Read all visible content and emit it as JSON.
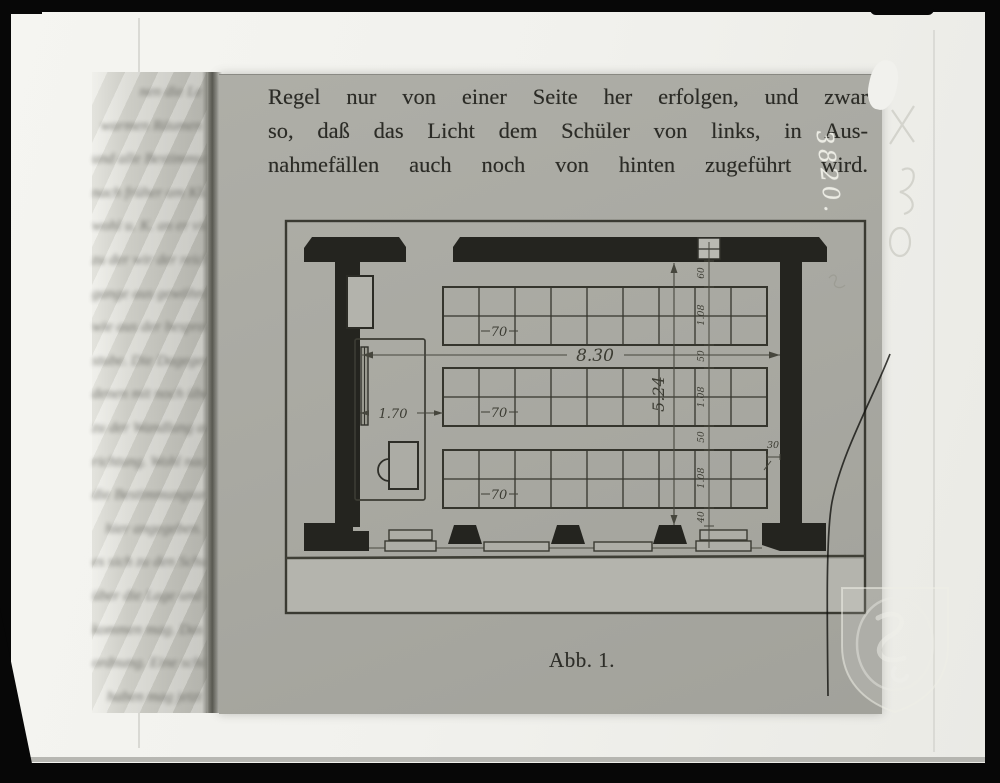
{
  "photo": {
    "handwritten_number": "3820."
  },
  "book": {
    "paragraph_lines": [
      "Regel nur von einer Seite her erfolgen, und zwar",
      "so, daß das Licht dem Schüler von links, in Aus-",
      "nahmefällen auch noch von hinten zugeführt wird."
    ],
    "caption": "Abb. 1."
  },
  "figure": {
    "room_width": "8.30",
    "room_depth": "5.24",
    "front_area_depth": "1.70",
    "desk_width": "70",
    "side_gap": "30",
    "depth_chain": [
      "60",
      "1.08",
      "50",
      "1.08",
      "50",
      "1.08",
      "40"
    ]
  },
  "left_page": {
    "blurred_line_fragments": [
      "nen die Le",
      "warmen Räumen",
      "und alle Bestimmung",
      "nach früher am Klasse",
      "wohl u. K. an er vielen",
      "zu der wir der reicher",
      "gange aus gewöhnliche",
      "wie aus der besprechende",
      "stube. Die Dagegenwohl",
      "denen mit noch über",
      "zu der Wandlung ausge-",
      "richtung. Wohl nach all-",
      "die Bestimmungsungen",
      "hier angegeben.",
      "es sich zu den Schulen",
      "über die Lage und des",
      "kommen mag. Das",
      "ordnung. Eine schön",
      "haben mag jetzt"
    ]
  },
  "colors": {
    "page_gray": "#a9a9a2",
    "film_white": "#f1f1ed",
    "ink": "#2b2b26",
    "wall_black": "#24241f",
    "plan_line": "#3b3b33",
    "pavement": "#b4b4ad"
  }
}
